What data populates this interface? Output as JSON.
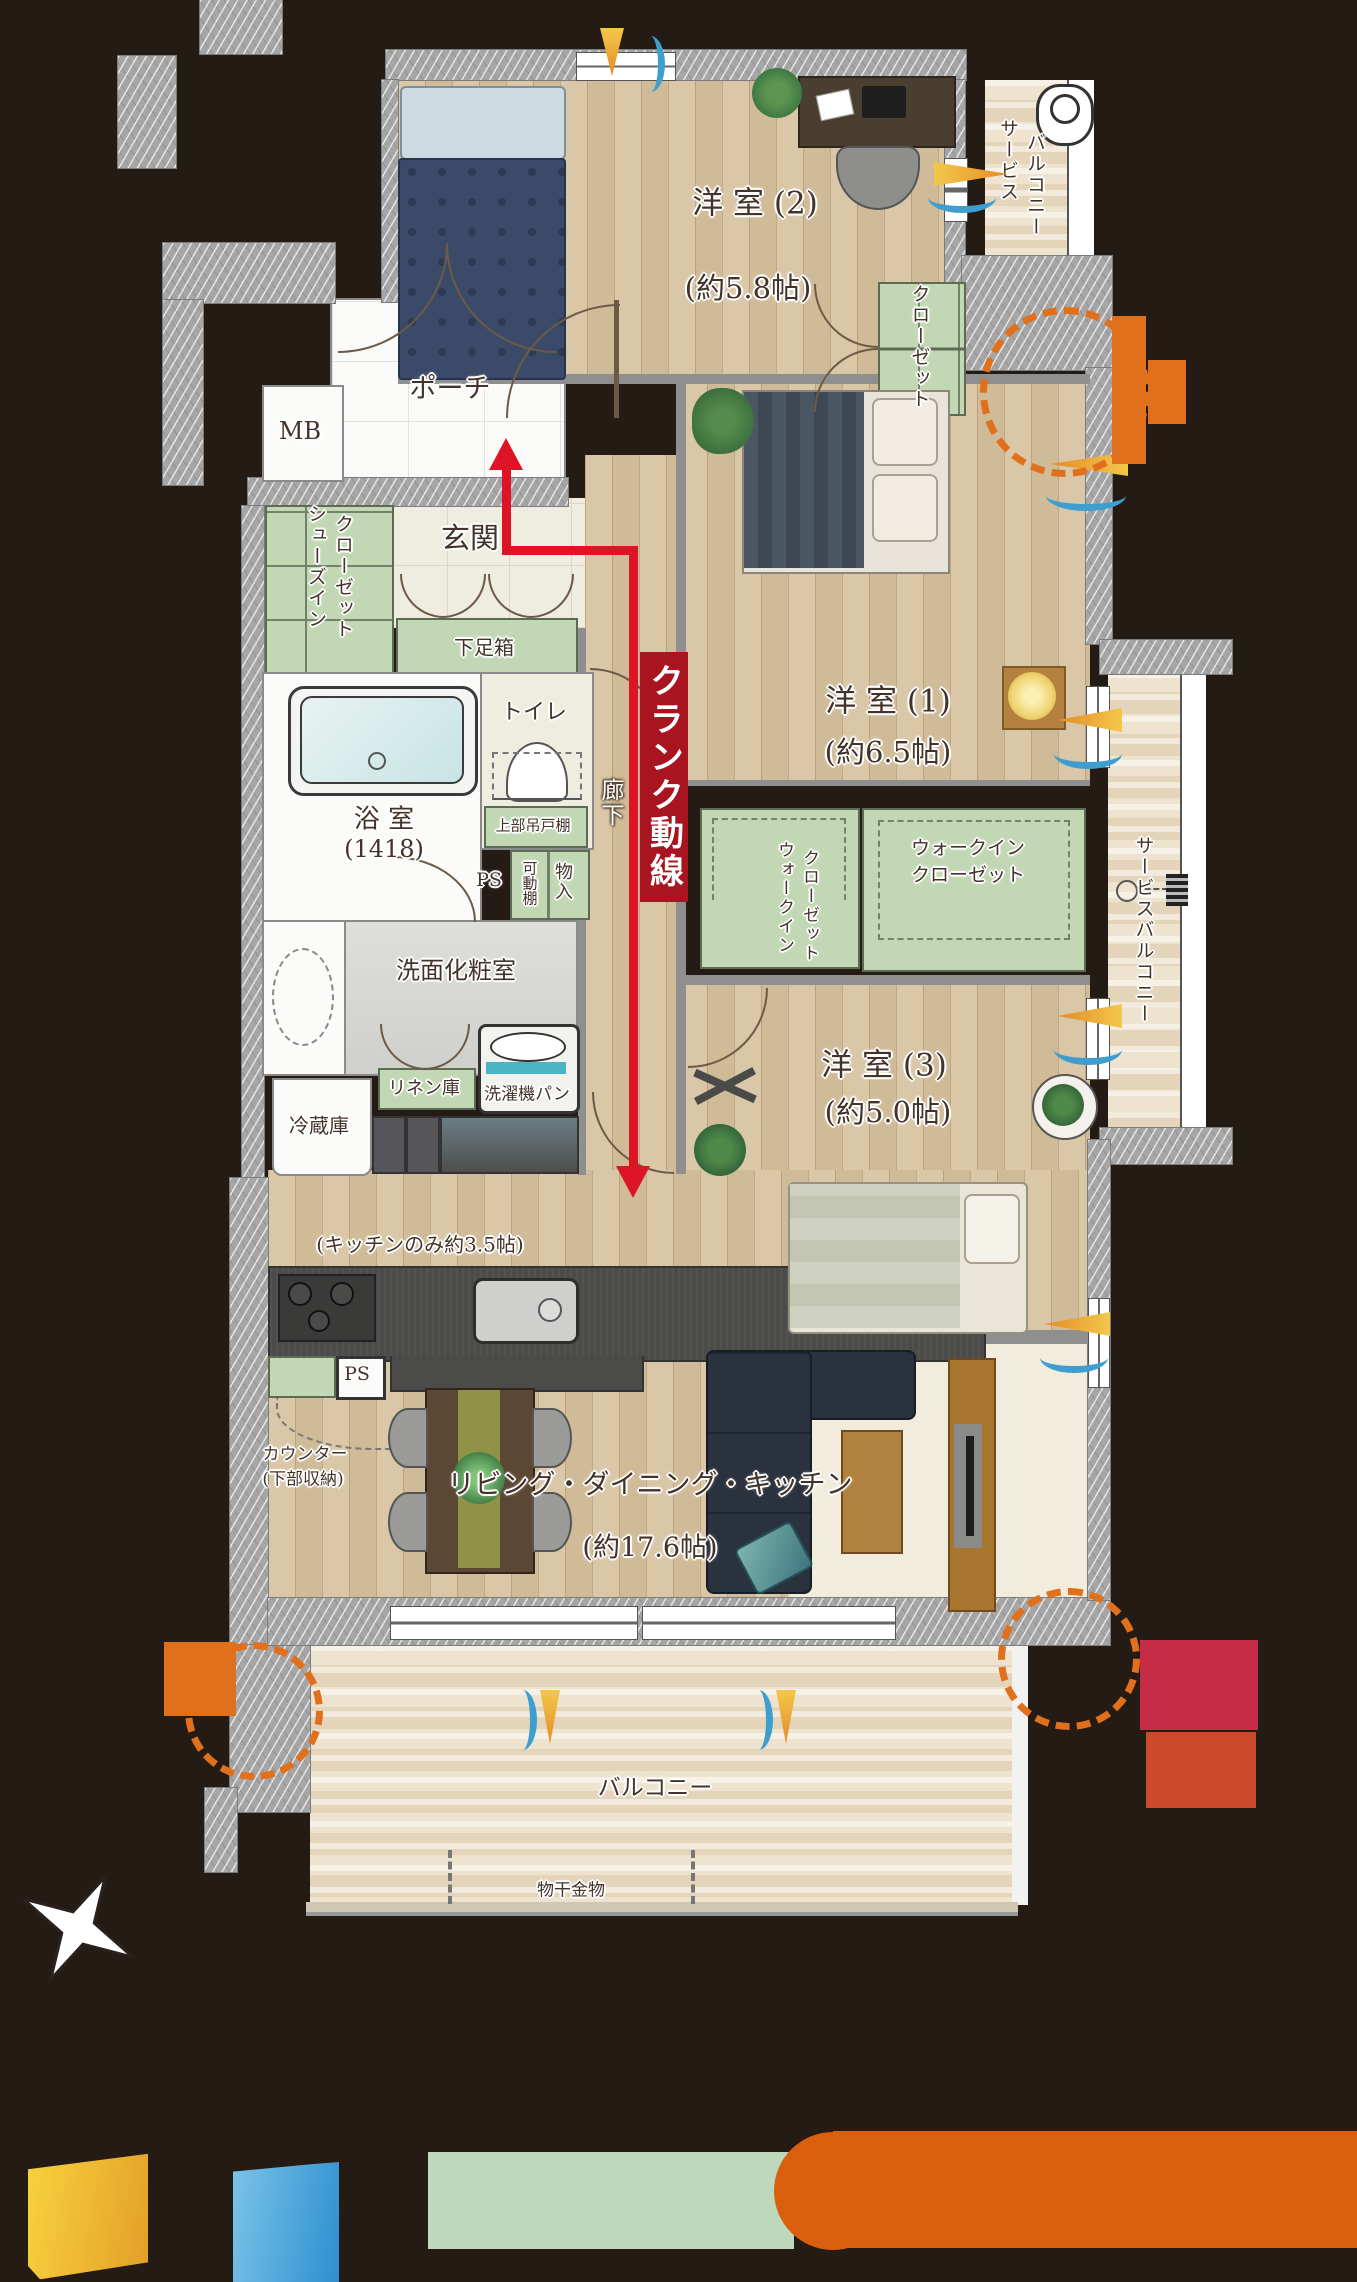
{
  "flow": {
    "label": "クランク動線",
    "banner_color": "#a81520",
    "line_color": "#dc1425"
  },
  "rooms": {
    "western2_name": "洋 室 (2)",
    "western2_size": "(約5.8帖)",
    "western1_name": "洋 室 (1)",
    "western1_size": "(約6.5帖)",
    "western3_name": "洋 室 (3)",
    "western3_size": "(約5.0帖)",
    "ldk_name": "リビング・ダイニング・キッチン",
    "ldk_size": "(約17.6帖)",
    "kitchen_note": "(キッチンのみ約3.5帖)",
    "porch": "ポーチ",
    "entrance": "玄関",
    "mb": "MB",
    "corridor": "廊下",
    "bathroom_name": "浴 室",
    "bathroom_size": "(1418)",
    "toilet": "トイレ",
    "washroom": "洗面化粧室",
    "balcony": "バルコニー",
    "sb_top_1": "サービス",
    "sb_top_2": "バルコニー",
    "sb_right": "サービスバルコニー"
  },
  "storage": {
    "closet": "クローゼット",
    "sic_1": "シューズイン",
    "sic_2": "クローゼット",
    "getabako": "下足箱",
    "upper_cabinet": "上部吊戸棚",
    "movable_shelf": "可動棚",
    "storage_in": "物入",
    "wic_l_1": "ウォークイン",
    "wic_l_2": "クローゼット",
    "wic_r_1": "ウォークイン",
    "wic_r_2": "クローゼット",
    "linen": "リネン庫",
    "counter_1": "カウンター",
    "counter_2": "(下部収納)"
  },
  "fixtures": {
    "washer_pan": "洗濯機パン",
    "fridge": "冷蔵庫",
    "ps_bath": "PS",
    "ps_kitchen": "PS",
    "laundry_hardware": "物干金物"
  },
  "colors": {
    "background": "#241b15",
    "storage_green": "#c2d8b4",
    "wall_gray": "#a6a6a6",
    "accent_orange": "#e0701c",
    "flow_red": "#dc1425",
    "legend_yellow": "#f0c23a",
    "legend_blue": "#4aa8dd",
    "legend_green": "#bed8bc",
    "legend_orange": "#d95f0e"
  }
}
